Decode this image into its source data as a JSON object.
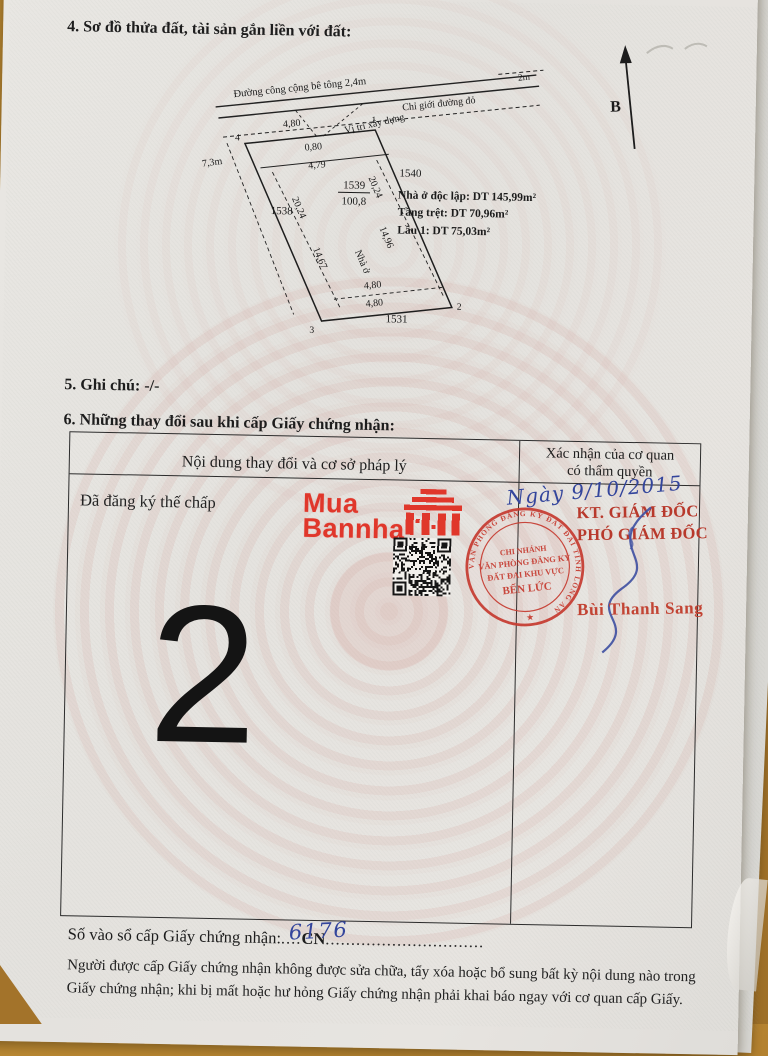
{
  "document": {
    "section4_heading": "4. Sơ đồ thửa đất, tài sản gắn liền với đất:",
    "section5_heading": "5. Ghi chú: -/-",
    "section6_heading": "6. Những thay đổi sau khi cấp Giấy chứng nhận:"
  },
  "diagram": {
    "north": "B",
    "road_label": "Đường công cộng bê tông 2,4m",
    "road_dim": "2m",
    "red_boundary_label": "Chỉ giới đường đỏ",
    "build_position_label": "Vị trí xây dựng",
    "setback_dim": "0,80",
    "left_dim": "7,3m",
    "edge_top": "4,80",
    "edge_inner_top": "4,79",
    "edge_left": "20,24",
    "edge_right": "20,24",
    "edge_inner_bottom": "4,80",
    "edge_bottom": "4,80",
    "house_edge_left": "14,67",
    "house_edge_right": "14,96",
    "house_label": "Nhà ở",
    "parcel_no": "1539",
    "parcel_area": "100,8",
    "adj_left": "1538",
    "adj_right": "1540",
    "adj_bottom": "1531",
    "pt1": "1",
    "pt2": "2",
    "pt3": "3",
    "pt4": "4",
    "info1": "Nhà ở độc lập: DT 145,99m²",
    "info2": "Tầng trệt: DT 70,96m²",
    "info3": "Lầu 1: DT 75,03m²"
  },
  "table": {
    "col1_header": "Nội dung thay đổi và cơ sở pháp lý",
    "col2_header_line1": "Xác nhận của cơ quan",
    "col2_header_line2": "có thẩm quyền",
    "entry_text": "Đã đăng ký thế chấp",
    "page_number": "2"
  },
  "watermark": {
    "line1": "Mua",
    "line2": "Bannha",
    "color": "#e0372b"
  },
  "approval": {
    "date_handwritten": "Ngày 9/10/2015",
    "title_line1": "KT. GIÁM ĐỐC",
    "title_line2": "PHÓ GIÁM ĐỐC",
    "signer": "Bùi Thanh Sang",
    "stamp_ring": "VĂN PHÒNG ĐĂNG KÝ ĐẤT ĐAI TỈNH LONG AN",
    "stamp_star": "★",
    "stamp_line1": "CHI NHÁNH",
    "stamp_line2": "VĂN PHÒNG ĐĂNG KÝ",
    "stamp_line3": "ĐẤT ĐAI KHU VỰC",
    "stamp_line4": "BẾN LỨC",
    "ink_blue": "#33459c",
    "stamp_red": "#c63c31"
  },
  "footer": {
    "registry_label": "Số vào sổ cấp Giấy chứng nhận:",
    "registry_dots1": "....",
    "registry_code": "CN",
    "registry_dots2": "...............................",
    "registry_number": "6176",
    "note_line1": "Người được cấp Giấy chứng nhận không được sửa chữa, tẩy xóa hoặc bổ sung bất kỳ nội dung nào trong",
    "note_line2": "Giấy chứng nhận; khi bị mất hoặc hư hỏng Giấy chứng nhận phải khai báo ngay với cơ quan cấp Giấy."
  }
}
